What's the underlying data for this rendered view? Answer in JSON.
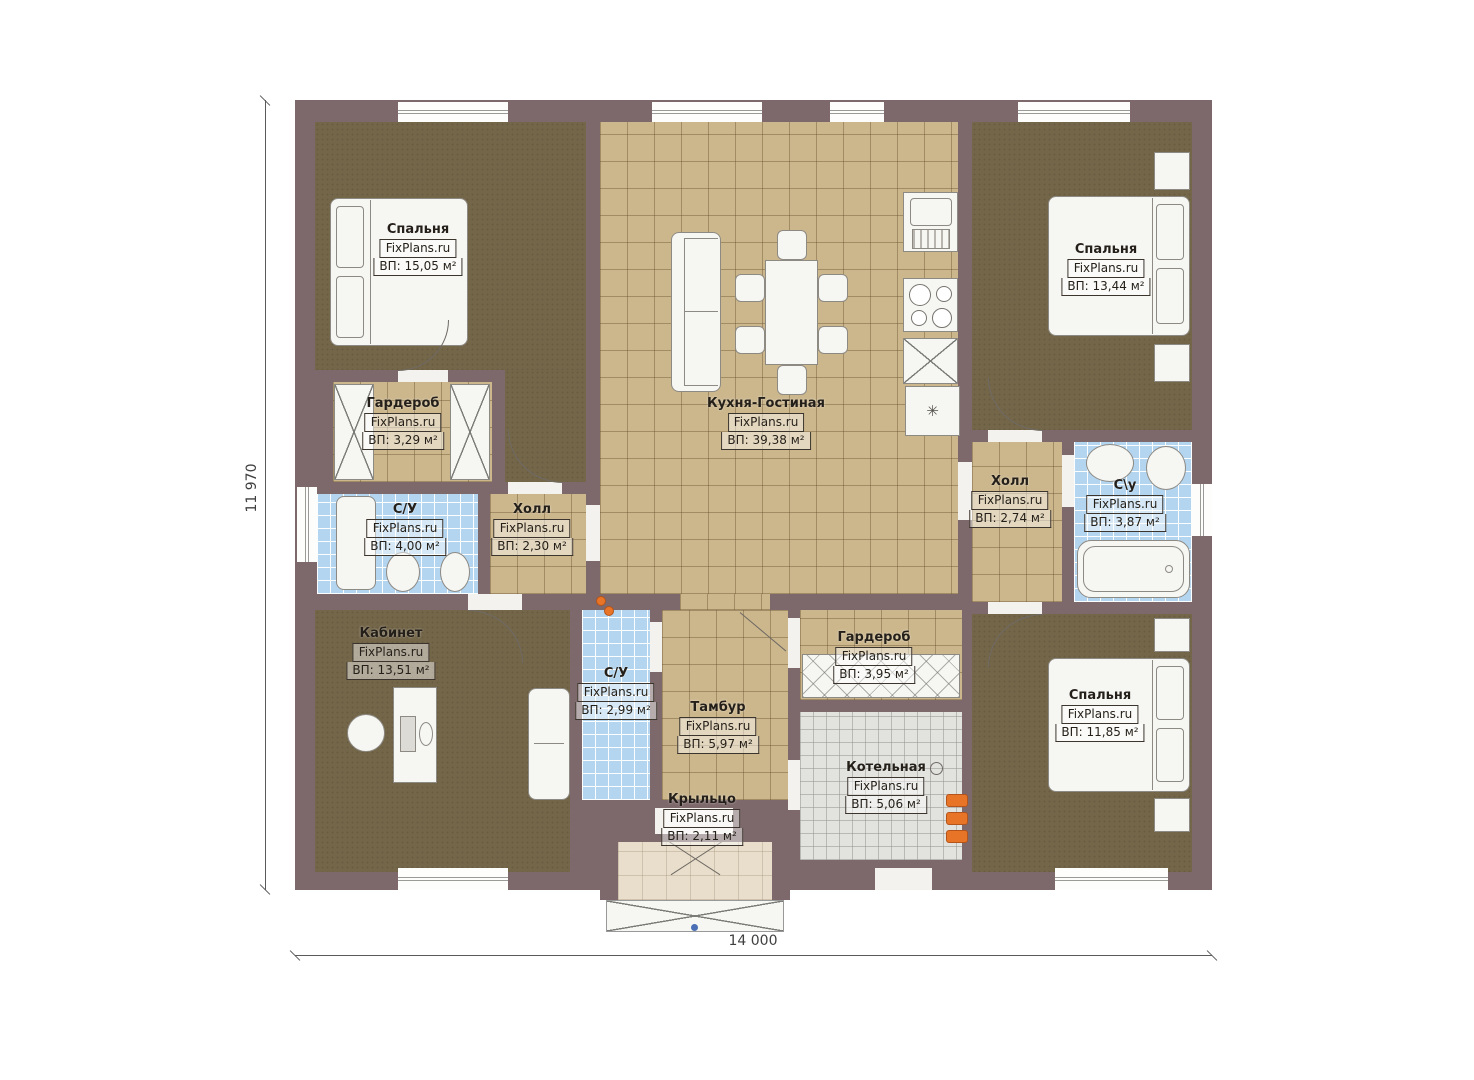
{
  "plan": {
    "watermark": "FixPlans.ru",
    "dimensions": {
      "bottom": "14 000",
      "left": "11 970"
    },
    "rooms": [
      {
        "name": "Спальня",
        "watermark": "FixPlans.ru",
        "area": "ВП: 15,05 м²"
      },
      {
        "name": "Гардероб",
        "watermark": "FixPlans.ru",
        "area": "ВП: 3,29 м²"
      },
      {
        "name": "С/У",
        "watermark": "FixPlans.ru",
        "area": "ВП: 4,00 м²"
      },
      {
        "name": "Холл",
        "watermark": "FixPlans.ru",
        "area": "ВП: 2,30 м²"
      },
      {
        "name": "Кухня-Гостиная",
        "watermark": "FixPlans.ru",
        "area": "ВП: 39,38 м²"
      },
      {
        "name": "Спальня",
        "watermark": "FixPlans.ru",
        "area": "ВП: 13,44 м²"
      },
      {
        "name": "Холл",
        "watermark": "FixPlans.ru",
        "area": "ВП: 2,74 м²"
      },
      {
        "name": "С\\у",
        "watermark": "FixPlans.ru",
        "area": "ВП: 3,87 м²"
      },
      {
        "name": "Кабинет",
        "watermark": "FixPlans.ru",
        "area": "ВП: 13,51 м²"
      },
      {
        "name": "С/У",
        "watermark": "FixPlans.ru",
        "area": "ВП: 2,99 м²"
      },
      {
        "name": "Тамбур",
        "watermark": "FixPlans.ru",
        "area": "ВП: 5,97 м²"
      },
      {
        "name": "Гардероб",
        "watermark": "FixPlans.ru",
        "area": "ВП: 3,95 м²"
      },
      {
        "name": "Котельная",
        "watermark": "FixPlans.ru",
        "area": "ВП: 5,06 м²"
      },
      {
        "name": "Спальня",
        "watermark": "FixPlans.ru",
        "area": "ВП: 11,85 м²"
      },
      {
        "name": "Крыльцо",
        "watermark": "FixPlans.ru",
        "area": "ВП: 2,11 м²"
      }
    ],
    "icons": {
      "fridge_snowflake": "✳"
    },
    "colors": {
      "wall": "#7d686b",
      "bedroom_floor": "#746649",
      "tile_floor": "#ccb78d",
      "bath_floor": "#b4d5ef",
      "boiler_floor": "#e2e2df",
      "porch_floor": "#e8decb"
    }
  }
}
